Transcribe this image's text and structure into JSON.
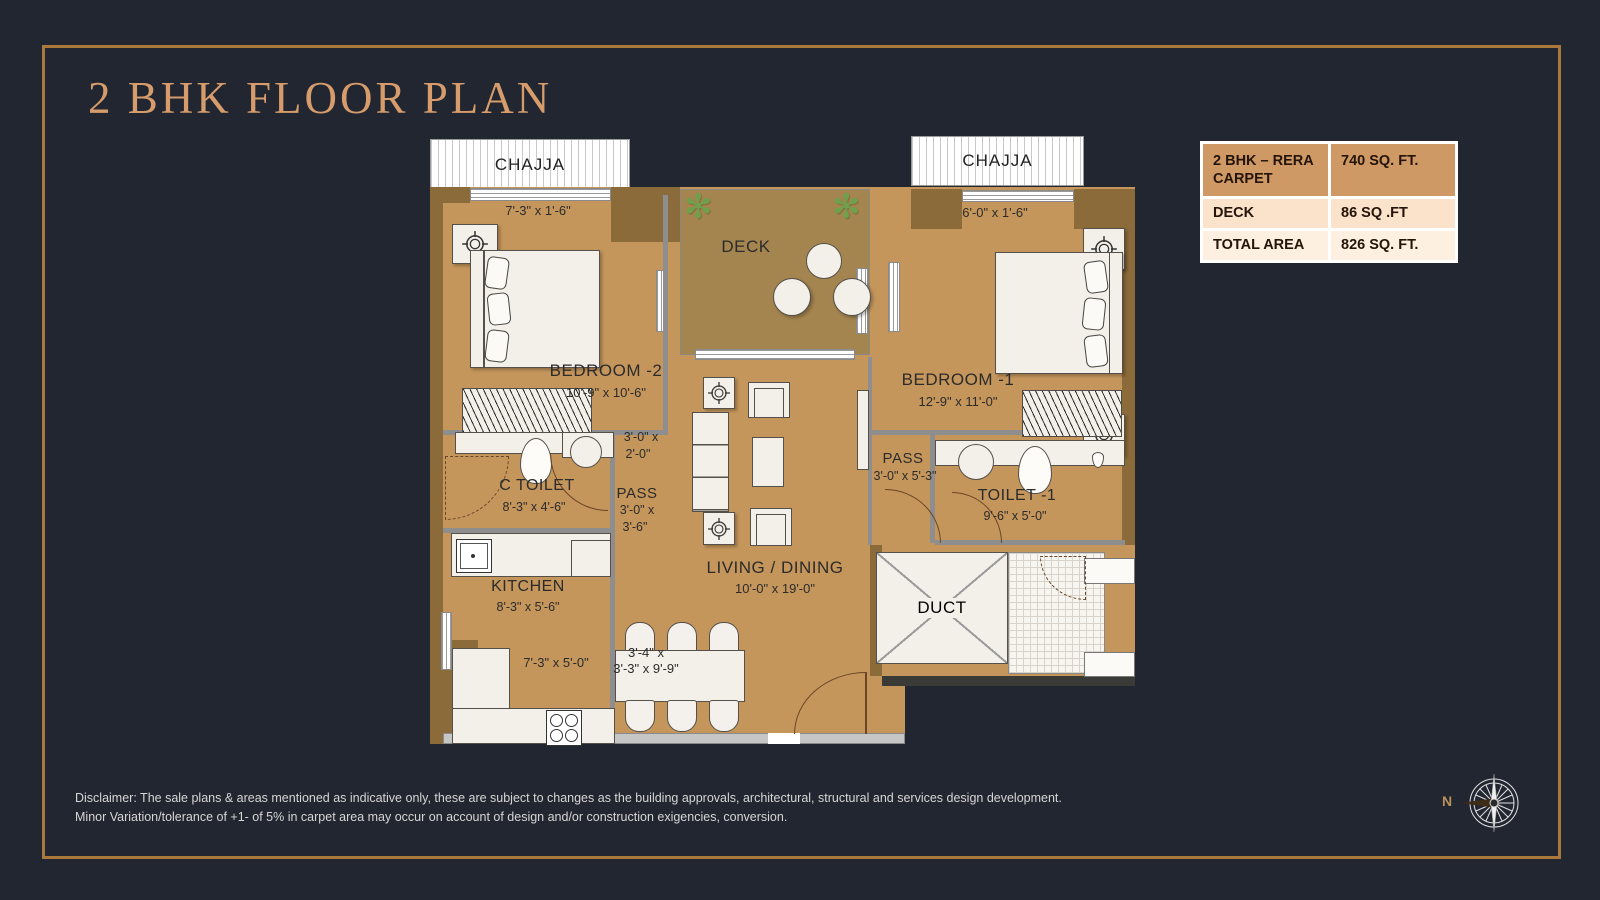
{
  "title": "2 BHK FLOOR PLAN",
  "area_table": {
    "rows": [
      {
        "label": "2 BHK – RERA CARPET",
        "value": "740 SQ. FT."
      },
      {
        "label": "DECK",
        "value": "86 SQ .FT"
      },
      {
        "label": "TOTAL AREA",
        "value": "826 SQ. FT."
      }
    ]
  },
  "plan": {
    "chajja_left": {
      "name": "CHAJJA",
      "dims": "7'-3\" x 1'-6\""
    },
    "chajja_right": {
      "name": "CHAJJA",
      "dims": "6'-0\" x 1'-6\""
    },
    "deck": {
      "name": "DECK"
    },
    "bedroom2": {
      "name": "BEDROOM -2",
      "dims": "10'-9\" x 10'-6\""
    },
    "bedroom1": {
      "name": "BEDROOM -1",
      "dims": "12'-9\" x 11'-0\""
    },
    "pass_upper": {
      "line1": "3'-0\" x",
      "line2": "2'-0\""
    },
    "c_toilet": {
      "name": "C TOILET",
      "dims": "8'-3\" x 4'-6\""
    },
    "pass_left": {
      "name": "PASS",
      "line1": "3'-0\" x",
      "line2": "3'-6\""
    },
    "kitchen": {
      "name": "KITCHEN",
      "dims": "8'-3\" x 5'-6\"",
      "platform_dims": "7'-3\" x 5'-0\""
    },
    "living": {
      "name": "LIVING / DINING",
      "dims": "10'-0\" x 19'-0\""
    },
    "dining": {
      "line1": "3'-4\" x",
      "line2": "3'-3\" x 9'-9\""
    },
    "pass_right": {
      "name": "PASS",
      "dims": "3'-0\" x 5'-3\""
    },
    "toilet1": {
      "name": "TOILET -1",
      "dims": "9'-6\" x 5'-0\""
    },
    "duct": {
      "name": "DUCT"
    }
  },
  "icons": {
    "plant": "✻"
  },
  "compass": {
    "north_label": "N"
  },
  "disclaimer": {
    "line1": "Disclaimer: The sale plans & areas mentioned as indicative only, these are subject to changes as the building approvals, architectural, structural and services design development.",
    "line2": "Minor Variation/tolerance of +1- of 5% in carpet area may occur on account of design and/or construction exigencies, conversion."
  },
  "colors": {
    "background": "#212630",
    "frame_accent": "#a9783a",
    "title_accent": "#d69c6b",
    "floor_tan": "#c5965c",
    "deck_tan": "#a5854f",
    "wall_brown": "#8c6b3a",
    "table_header": "#cf9965",
    "table_row_deck": "#fbe2ca",
    "table_row_total": "#fdf0e0"
  }
}
